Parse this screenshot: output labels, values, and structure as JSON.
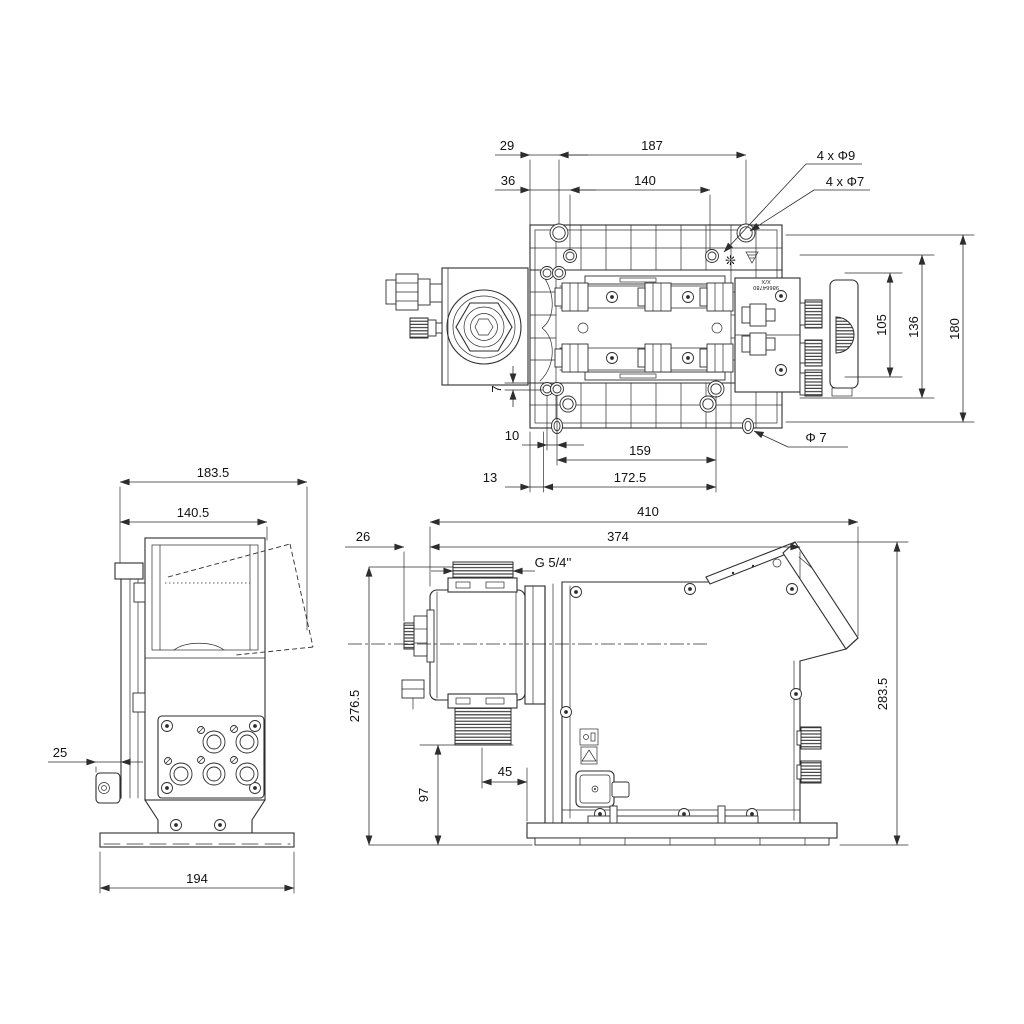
{
  "drawing": {
    "background": "#ffffff",
    "stroke_color": "#2d2d2d",
    "top": {
      "d29": "29",
      "d187": "187",
      "d36": "36",
      "d140": "140",
      "holes9": "4 x Φ9",
      "holes7": "4 x Φ7",
      "d105": "105",
      "d136": "136",
      "d180": "180",
      "d7": "7",
      "d10": "10",
      "d159": "159",
      "dia7": "Φ 7",
      "d13": "13",
      "d172_5": "172.5",
      "nameplate_1": "X/X",
      "nameplate_2": "98664780"
    },
    "side": {
      "d183_5": "183.5",
      "d140_5": "140.5",
      "d25": "25",
      "d194": "194"
    },
    "front": {
      "d410": "410",
      "d374": "374",
      "d26": "26",
      "thread": "G 5/4''",
      "d276_5": "276.5",
      "d97": "97",
      "d45": "45",
      "d283_5": "283.5"
    }
  }
}
